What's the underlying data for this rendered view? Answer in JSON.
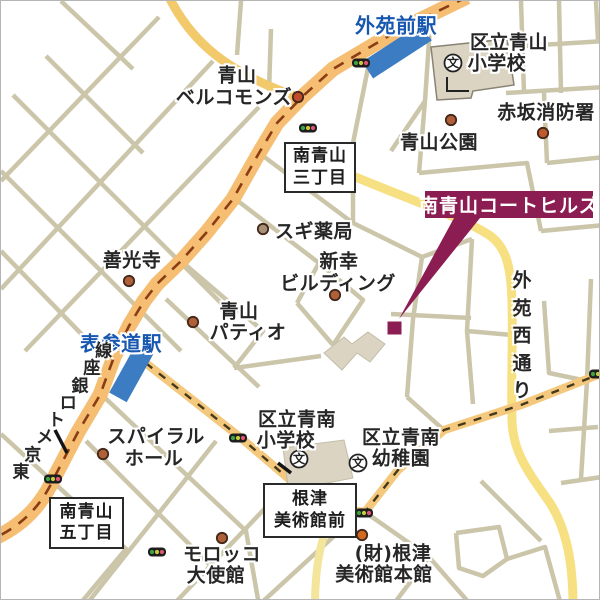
{
  "map": {
    "colors": {
      "road_main": "#F5BE72",
      "road_main_dash": "#8A3C14",
      "road_yellow": "#F7E082",
      "road_yellow_warm": "#F2C96B",
      "road_yellow_pale": "#F3E59C",
      "road_orange_light": "#F4C97E",
      "dash_dark": "#45391C",
      "minor": "#CBC5AA",
      "station_fill": "#3C7CC2",
      "station_text": "#1857B0",
      "banner_bg": "#8C1D52",
      "label": "#262626",
      "building": "#DBD4C3",
      "building_edge": "#8A8374"
    },
    "roads": [
      {
        "id": "street",
        "d": "M212,60 L0,288",
        "c": "minor",
        "w": 4.5
      },
      {
        "id": "street",
        "d": "M258,106 L24,350",
        "c": "minor",
        "w": 4.5
      },
      {
        "id": "street",
        "d": "M158,16 L0,180",
        "c": "minor",
        "w": 4.5
      },
      {
        "id": "street",
        "d": "M12,94 L234,316",
        "c": "minor",
        "w": 4.5
      },
      {
        "id": "street",
        "d": "M0,170 L180,350",
        "c": "minor",
        "w": 4.5
      },
      {
        "id": "street",
        "d": "M45,55 L142,152",
        "c": "minor",
        "w": 4.5
      },
      {
        "id": "street",
        "d": "M0,250 L92,345",
        "c": "minor",
        "w": 4.5
      },
      {
        "id": "street",
        "d": "M60,0 L132,68",
        "c": "minor",
        "w": 4.5
      },
      {
        "id": "street",
        "d": "M240,0 L236,54",
        "c": "minor",
        "w": 4.5
      },
      {
        "id": "street",
        "d": "M270,28 L268,90",
        "c": "minor",
        "w": 4.5
      },
      {
        "id": "street",
        "d": "M368,62 L352,142 L352,222",
        "c": "minor",
        "w": 4.5
      },
      {
        "id": "street",
        "d": "M258,152 L352,222",
        "c": "minor",
        "w": 4.5
      },
      {
        "id": "street",
        "d": "M233,197 L318,262 L296,302",
        "c": "minor",
        "w": 4.5
      },
      {
        "id": "street",
        "d": "M318,262 L362,299 L332,344",
        "c": "minor",
        "w": 4.5
      },
      {
        "id": "street",
        "d": "M296,302 L332,344",
        "c": "minor",
        "w": 4.5
      },
      {
        "id": "street",
        "d": "M180,260 L262,330 L233,367",
        "c": "minor",
        "w": 4.5
      },
      {
        "id": "street",
        "d": "M165,298 L258,386",
        "c": "minor",
        "w": 4.5
      },
      {
        "id": "street",
        "d": "M233,367 L320,355",
        "c": "minor",
        "w": 4.5
      },
      {
        "id": "street",
        "d": "M102,395 L245,530 L258,604",
        "c": "minor",
        "w": 4.5
      },
      {
        "id": "street",
        "d": "M352,222 L421,256 L471,238",
        "c": "minor",
        "w": 4.5
      },
      {
        "id": "street",
        "d": "M421,256 L412,318 L406,396",
        "c": "minor",
        "w": 4.5
      },
      {
        "id": "street",
        "d": "M390,313 L470,317",
        "c": "minor",
        "w": 4.5
      },
      {
        "id": "street",
        "d": "M471,238 L466,330 L472,403",
        "c": "minor",
        "w": 4.5
      },
      {
        "id": "street",
        "d": "M466,330 L511,334",
        "c": "minor",
        "w": 4.5
      },
      {
        "id": "street",
        "d": "M406,396 L444,430",
        "c": "minor",
        "w": 4.5
      },
      {
        "id": "street",
        "d": "M543,300 L548,372 L586,380",
        "c": "minor",
        "w": 4.5
      },
      {
        "id": "street",
        "d": "M590,278 L586,380 L580,478",
        "c": "minor",
        "w": 4.5
      },
      {
        "id": "street",
        "d": "M548,430 L597,426",
        "c": "minor",
        "w": 4.5
      },
      {
        "id": "street",
        "d": "M560,482 L601,476",
        "c": "minor",
        "w": 4.5
      },
      {
        "id": "street",
        "d": "M430,10 L424,100 L418,172",
        "c": "minor",
        "w": 4.5
      },
      {
        "id": "street",
        "d": "M424,100 L390,150",
        "c": "minor",
        "w": 4.5
      },
      {
        "id": "street",
        "d": "M418,172 L526,162 L540,230",
        "c": "minor",
        "w": 4.5
      },
      {
        "id": "street",
        "d": "M520,0 L523,92",
        "c": "minor",
        "w": 4.5
      },
      {
        "id": "street",
        "d": "M558,0 L560,92",
        "c": "minor",
        "w": 4.5
      },
      {
        "id": "street",
        "d": "M505,92 L604,86",
        "c": "minor",
        "w": 4.5
      },
      {
        "id": "street",
        "d": "M523,45 L604,40",
        "c": "minor",
        "w": 4.5
      },
      {
        "id": "street",
        "d": "M543,92 L546,162",
        "c": "minor",
        "w": 4.5
      },
      {
        "id": "street",
        "d": "M546,162 L604,156",
        "c": "minor",
        "w": 4.5
      },
      {
        "id": "street",
        "d": "M540,230 L604,224",
        "c": "minor",
        "w": 4.5
      },
      {
        "id": "street",
        "d": "M595,0 L597,40",
        "c": "minor",
        "w": 4.5
      },
      {
        "id": "street",
        "d": "M85,440 L228,583",
        "c": "minor",
        "w": 4.5
      },
      {
        "id": "street",
        "d": "M0,433 L125,548 L78,604",
        "c": "minor",
        "w": 4.5
      },
      {
        "id": "street",
        "d": "M215,440 L85,604",
        "c": "minor",
        "w": 4.5
      },
      {
        "id": "street",
        "d": "M290,480 L172,604",
        "c": "minor",
        "w": 4.5
      },
      {
        "id": "street",
        "d": "M355,515 L258,604",
        "c": "minor",
        "w": 4.5
      },
      {
        "id": "street",
        "d": "M364,511 L428,556 L470,604",
        "c": "minor",
        "w": 4.5
      },
      {
        "id": "street",
        "d": "M428,556 L392,604",
        "c": "minor",
        "w": 4.5
      },
      {
        "id": "street",
        "d": "M455,532 L498,526 L506,558 L482,575 L458,567 L455,532",
        "c": "minor",
        "w": 4.5
      },
      {
        "id": "street",
        "d": "M506,558 L544,546 L560,604",
        "c": "minor",
        "w": 4.5
      },
      {
        "id": "street",
        "d": "M480,480 L540,540",
        "c": "minor",
        "w": 4.5
      },
      {
        "id": "yellow-road-northwest",
        "d": "M168,-4 C190,40 225,72 302,98",
        "c": "road_yellow_warm",
        "w": 9
      },
      {
        "id": "gaien-nishi-dori-road",
        "d": "M296,150 C370,186 455,212 488,234 C506,246 510,268 511,300 C512,340 510,380 511,420 C512,452 528,472 549,502 C563,524 572,555 572,604",
        "c": "road_yellow",
        "w": 9
      },
      {
        "id": "yellow-road-south",
        "d": "M332,508 C323,532 314,556 314,604",
        "c": "road_yellow_pale",
        "w": 8
      },
      {
        "id": "miyuki-street-west",
        "d": "M132,352 L240,437 L301,489 L333,508",
        "c": "road_orange_light",
        "w": 8.5
      },
      {
        "id": "miyuki-street-east",
        "d": "M604,371 L520,404 L443,429 L397,469 L364,511 L333,508",
        "c": "road_orange_light",
        "w": 8.5
      },
      {
        "id": "miyuki-street-west-dashes",
        "d": "M132,352 L240,437 L301,489 L333,508",
        "c": "dash_dark",
        "w": 2.4,
        "dash": "8,8.5"
      },
      {
        "id": "miyuki-street-east-dashes",
        "d": "M604,371 L520,404 L443,429 L397,469 L364,511 L333,508",
        "c": "dash_dark",
        "w": 2.4,
        "dash": "8,8.5"
      },
      {
        "id": "aoyama-dori-road",
        "d": "M466,-4 L396,30 L332,68 L302,95 L276,122 L258,152 L232,198 L205,232 L180,260 L156,283 L143,300 L128,325 L113,356 L99,394 L77,431 L53,477 C40,505 22,523 -4,536",
        "c": "road_main",
        "w": 15
      },
      {
        "id": "ginza-line-dashes",
        "d": "M466,-4 L396,30 L332,68 L302,95 L276,122 L258,152 L232,198 L205,232 L180,260 L156,283 L143,300 L128,325 L113,356 L99,394 L77,431 L53,477 C40,505 22,523 -4,536",
        "c": "road_main_dash",
        "w": 2.6,
        "dash": "11,9"
      }
    ],
    "buildings": [
      {
        "id": "aoyama-elementary-building",
        "points": "430,46 506,38 513,84 472,90 470,97 436,99",
        "edge": true
      },
      {
        "id": "seinan-elementary-building",
        "points": "282,447 343,439 352,477 316,484 313,491 288,493",
        "edge": false
      },
      {
        "id": "building-block",
        "points": "323,352 343,336 351,343 367,331 384,343 369,361 356,352 341,369",
        "edge": false
      }
    ],
    "building_detail": "M446,76 L446,90 L468,90",
    "stations": [
      {
        "id": "gaienmae-station-platform",
        "cx": 396,
        "cy": 50,
        "w": 70,
        "h": 20,
        "angle": -33
      },
      {
        "id": "omotesando-station-platform",
        "cx": 131,
        "cy": 371,
        "w": 20,
        "h": 58,
        "angle": 29
      }
    ],
    "poi_dots": [
      {
        "id": "bellcommons-dot",
        "x": 297,
        "y": 96,
        "fill": "#C04A2A"
      },
      {
        "id": "aoyama-park-dot",
        "x": 450,
        "y": 119,
        "fill": "#B06038"
      },
      {
        "id": "fire-station-dot",
        "x": 542,
        "y": 132,
        "fill": "#C05A2E"
      },
      {
        "id": "sugi-pharmacy-dot",
        "x": 262,
        "y": 228,
        "fill": "#A89078"
      },
      {
        "id": "zenkoji-dot",
        "x": 128,
        "y": 280,
        "fill": "#B06038"
      },
      {
        "id": "shinko-building-dot",
        "x": 334,
        "y": 294,
        "fill": "#B06038"
      },
      {
        "id": "patio-dot",
        "x": 192,
        "y": 321,
        "fill": "#B06038"
      },
      {
        "id": "spiral-hall-dot",
        "x": 102,
        "y": 453,
        "fill": "#B06038"
      },
      {
        "id": "morocco-embassy-dot",
        "x": 221,
        "y": 537,
        "fill": "#B06038"
      },
      {
        "id": "nezu-museum-dot",
        "x": 361,
        "y": 534,
        "fill": "#D2691E"
      }
    ],
    "school_icons": [
      {
        "id": "aoyama-elementary-school-icon",
        "x": 452,
        "y": 62,
        "glyph": "文"
      },
      {
        "id": "seinan-elementary-school-icon",
        "x": 298,
        "y": 458,
        "glyph": "文"
      },
      {
        "id": "seinan-kindergarten-icon",
        "x": 357,
        "y": 462,
        "glyph": "文"
      }
    ],
    "traffic_lights": [
      {
        "id": "traffic-light",
        "x": 360,
        "y": 62
      },
      {
        "id": "traffic-light",
        "x": 307,
        "y": 127
      },
      {
        "id": "traffic-light",
        "x": 52,
        "y": 478
      },
      {
        "id": "traffic-light",
        "x": 237,
        "y": 437
      },
      {
        "id": "traffic-light",
        "x": 363,
        "y": 512
      },
      {
        "id": "traffic-light",
        "x": 156,
        "y": 551
      },
      {
        "id": "traffic-light",
        "x": 597,
        "y": 373
      }
    ],
    "tick_marks": [
      {
        "id": "rail-tick",
        "d": "M54,429 L66,452"
      },
      {
        "id": "rail-tick",
        "d": "M277,462 L290,472"
      }
    ],
    "labels": [
      {
        "id": "gaienmae-station-label",
        "text": "外苑前駅",
        "x": 395,
        "y": 23,
        "style": "station"
      },
      {
        "id": "aoyama-elementary-label-1",
        "text": "区立青山",
        "x": 508,
        "y": 40
      },
      {
        "id": "aoyama-elementary-label-2",
        "text": "小学校",
        "x": 496,
        "y": 61
      },
      {
        "id": "bellcommons-label-1",
        "text": "青山",
        "x": 236,
        "y": 73
      },
      {
        "id": "bellcommons-label-2",
        "text": "ベルコモンズ",
        "x": 233,
        "y": 95
      },
      {
        "id": "akasaka-fire-station-label",
        "text": "赤坂消防署",
        "x": 545,
        "y": 110
      },
      {
        "id": "aoyama-park-label",
        "text": "青山公園",
        "x": 438,
        "y": 140
      },
      {
        "id": "sugi-pharmacy-label",
        "text": "スギ薬局",
        "x": 313,
        "y": 229
      },
      {
        "id": "shinko-building-label-1",
        "text": "新幸",
        "x": 338,
        "y": 259
      },
      {
        "id": "shinko-building-label-2",
        "text": "ビルディング",
        "x": 337,
        "y": 281
      },
      {
        "id": "zenkoji-label",
        "text": "善光寺",
        "x": 131,
        "y": 258
      },
      {
        "id": "aoyama-patio-label-1",
        "text": "青山",
        "x": 238,
        "y": 309
      },
      {
        "id": "aoyama-patio-label-2",
        "text": "パティオ",
        "x": 247,
        "y": 330
      },
      {
        "id": "omotesando-station-label",
        "text": "表参道駅",
        "x": 120,
        "y": 341,
        "style": "station"
      },
      {
        "id": "spiral-hall-label-1",
        "text": "スパイラル",
        "x": 155,
        "y": 434
      },
      {
        "id": "spiral-hall-label-2",
        "text": "ホール",
        "x": 153,
        "y": 456
      },
      {
        "id": "seinan-elementary-label-1",
        "text": "区立青南",
        "x": 296,
        "y": 417
      },
      {
        "id": "seinan-elementary-label-2",
        "text": "小学校",
        "x": 285,
        "y": 438
      },
      {
        "id": "seinan-kindergarten-label-1",
        "text": "区立青南",
        "x": 400,
        "y": 435
      },
      {
        "id": "seinan-kindergarten-label-2",
        "text": "幼稚園",
        "x": 400,
        "y": 456
      },
      {
        "id": "morocco-embassy-label-1",
        "text": "モロッコ",
        "x": 221,
        "y": 552
      },
      {
        "id": "morocco-embassy-label-2",
        "text": "大使館",
        "x": 215,
        "y": 573
      },
      {
        "id": "nezu-museum-main-label-1",
        "text": "(財)根津",
        "x": 392,
        "y": 551
      },
      {
        "id": "nezu-museum-main-label-2",
        "text": "美術館本館",
        "x": 383,
        "y": 572
      }
    ],
    "vertical_label": {
      "id": "gaien-nishi-dori-label",
      "text": "外苑西通り",
      "x": 521,
      "y": 278,
      "step": 27.5,
      "size": 19
    },
    "diagonal_label": {
      "id": "tokyo-metro-ginza-line-label",
      "text": "東京メトロ銀座線",
      "x": 20,
      "y": 469,
      "dx": 11.8,
      "dy": -17.3,
      "size": 17
    },
    "boxes": [
      {
        "id": "minami-aoyama-3chome-box",
        "lines": [
          "南青山",
          "三丁目"
        ],
        "x": 283,
        "y": 141,
        "w": 68,
        "h": 47
      },
      {
        "id": "minami-aoyama-5chome-box",
        "lines": [
          "南青山",
          "五丁目"
        ],
        "x": 48,
        "y": 496,
        "w": 71,
        "h": 48
      },
      {
        "id": "nezu-museum-mae-box",
        "lines": [
          "根津",
          "美術館前"
        ],
        "x": 262,
        "y": 482,
        "w": 90,
        "h": 51
      }
    ],
    "property": {
      "banner": {
        "text": "南青山コートヒルズ",
        "x": 424,
        "y": 190,
        "w": 168,
        "h": 27
      },
      "pointer": "453,217 479,217 398,318",
      "marker": {
        "x": 386.5,
        "y": 320.5,
        "w": 14,
        "h": 13
      }
    }
  }
}
